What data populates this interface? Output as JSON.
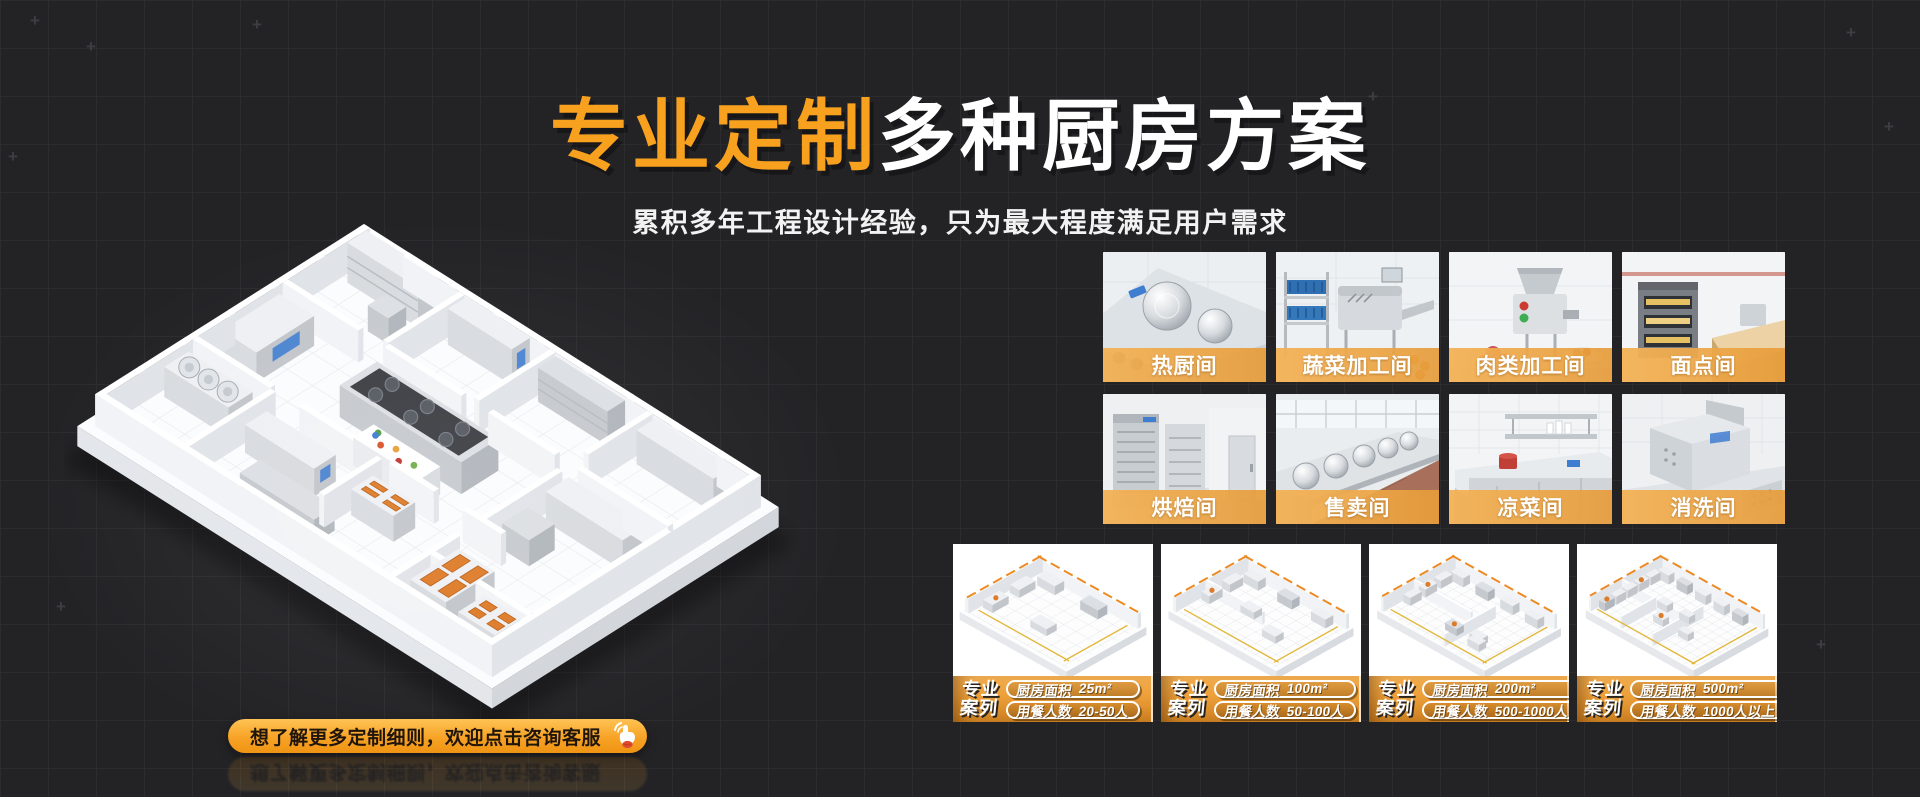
{
  "header": {
    "title_highlight": "专业定制",
    "title_rest": "多种厨房方案",
    "subtitle": "累积多年工程设计经验，只为最大程度满足用户需求"
  },
  "cta": {
    "label": "想了解更多定制细则，欢迎点击咨询客服",
    "icon": "hand-click-icon"
  },
  "illustration": {
    "name": "isometric-commercial-kitchen-floorplan"
  },
  "function_rooms": [
    {
      "label": "热厨间",
      "scene": "hot-kitchen"
    },
    {
      "label": "蔬菜加工间",
      "scene": "vegetable-processing"
    },
    {
      "label": "肉类加工间",
      "scene": "meat-processing"
    },
    {
      "label": "面点间",
      "scene": "pastry-room"
    },
    {
      "label": "烘焙间",
      "scene": "baking-room"
    },
    {
      "label": "售卖间",
      "scene": "selling-room"
    },
    {
      "label": "凉菜间",
      "scene": "cold-dish-room"
    },
    {
      "label": "消洗间",
      "scene": "dishwashing-room"
    }
  ],
  "cases": {
    "badge_line1": "专业",
    "badge_line2": "案列",
    "area_label": "厨房面积",
    "diners_label": "用餐人数",
    "items": [
      {
        "area": "25m²",
        "diners": "20-50人"
      },
      {
        "area": "100m²",
        "diners": "50-100人"
      },
      {
        "area": "200m²",
        "diners": "500-1000人"
      },
      {
        "area": "500m²",
        "diners": "1000人以上"
      }
    ]
  },
  "colors": {
    "accent_orange": "#F7A11E",
    "label_strip_orange": "#E99C3A",
    "banner_gradient_top": "#F5B052",
    "banner_gradient_bottom": "#CE8122",
    "background": "#232326",
    "grid_line": "#2C2C2F"
  }
}
